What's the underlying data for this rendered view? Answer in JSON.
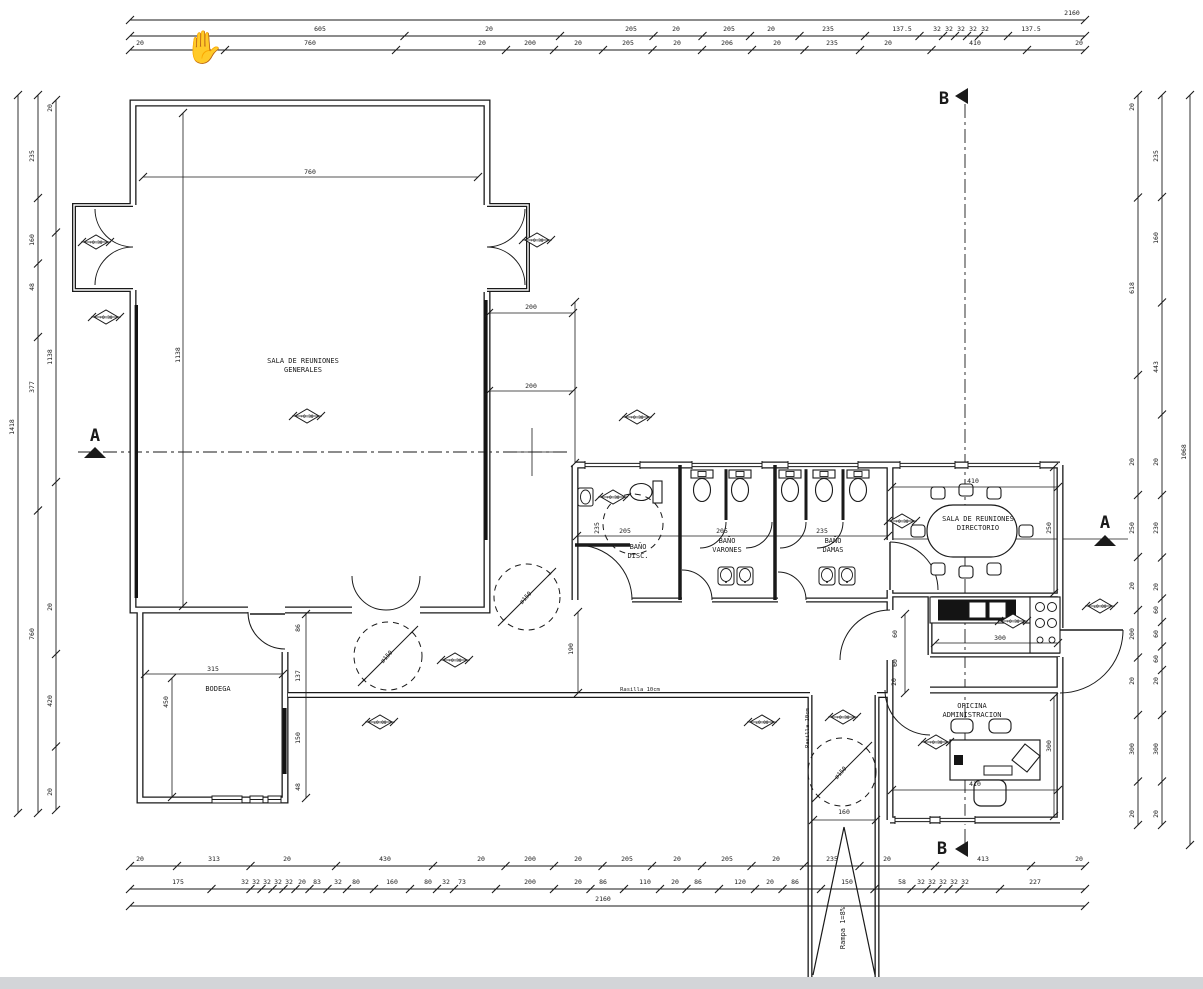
{
  "meta": {
    "background": "#ffffff",
    "line_color": "#1a1a1a",
    "cursor_glyph": "✋",
    "drawing_type": "architectural floor plan"
  },
  "rooms": [
    {
      "x": 303,
      "y": 363,
      "l1": "SALA DE REUNIONES",
      "l2": "GENERALES"
    },
    {
      "x": 218,
      "y": 691,
      "l1": "BODEGA",
      "l2": ""
    },
    {
      "x": 638,
      "y": 549,
      "l1": "BAÑO",
      "l2": "DISC."
    },
    {
      "x": 727,
      "y": 543,
      "l1": "BAÑO",
      "l2": "VARONES"
    },
    {
      "x": 833,
      "y": 543,
      "l1": "BAÑO",
      "l2": "DAMAS"
    },
    {
      "x": 978,
      "y": 521,
      "l1": "SALA DE REUNIONES",
      "l2": "DIRECTORIO"
    },
    {
      "x": 972,
      "y": 708,
      "l1": "OFICINA",
      "l2": "ADMINISTRACION"
    }
  ],
  "annotations": [
    {
      "x": 845,
      "y": 928,
      "t": "Rampa 1=8%",
      "r": -90,
      "s": 7
    },
    {
      "x": 640,
      "y": 691,
      "t": "Rasilla 10cm",
      "r": 0,
      "s": 5.5
    },
    {
      "x": 809,
      "y": 728,
      "t": "Rasilla 10cm",
      "r": -90,
      "s": 5.5
    },
    {
      "x": 527,
      "y": 599,
      "t": "ø150",
      "r": -48,
      "s": 6
    },
    {
      "x": 388,
      "y": 658,
      "t": "ø150",
      "r": -48,
      "s": 6
    },
    {
      "x": 842,
      "y": 774,
      "t": "ø150",
      "r": -48,
      "s": 6
    }
  ],
  "dim_rows": [
    {
      "line": 20,
      "ty": 15,
      "x1": 130,
      "x2": 1085,
      "labels": [
        {
          "x": 1072,
          "t": "2160"
        }
      ]
    },
    {
      "line": 36,
      "ty": 31,
      "x1": 130,
      "x2": 1085,
      "labels": [
        {
          "x": 320,
          "t": "605"
        },
        {
          "x": 489,
          "t": "20"
        },
        {
          "x": 631,
          "t": "205"
        },
        {
          "x": 676,
          "t": "20"
        },
        {
          "x": 729,
          "t": "205"
        },
        {
          "x": 771,
          "t": "20"
        },
        {
          "x": 828,
          "t": "235"
        },
        {
          "x": 902,
          "t": "137.5"
        },
        {
          "x": 937,
          "t": "32"
        },
        {
          "x": 949,
          "t": "32"
        },
        {
          "x": 961,
          "t": "32"
        },
        {
          "x": 973,
          "t": "32"
        },
        {
          "x": 985,
          "t": "32"
        },
        {
          "x": 1031,
          "t": "137.5"
        }
      ]
    },
    {
      "line": 50,
      "ty": 45,
      "x1": 130,
      "x2": 1085,
      "labels": [
        {
          "x": 140,
          "t": "20"
        },
        {
          "x": 310,
          "t": "760"
        },
        {
          "x": 482,
          "t": "20"
        },
        {
          "x": 530,
          "t": "200"
        },
        {
          "x": 578,
          "t": "20"
        },
        {
          "x": 628,
          "t": "205"
        },
        {
          "x": 677,
          "t": "20"
        },
        {
          "x": 727,
          "t": "206"
        },
        {
          "x": 777,
          "t": "20"
        },
        {
          "x": 832,
          "t": "235"
        },
        {
          "x": 888,
          "t": "20"
        },
        {
          "x": 975,
          "t": "410"
        },
        {
          "x": 1079,
          "t": "20"
        }
      ]
    },
    {
      "line": 866,
      "ty": 861,
      "x1": 130,
      "x2": 1085,
      "labels": [
        {
          "x": 140,
          "t": "20"
        },
        {
          "x": 214,
          "t": "313"
        },
        {
          "x": 287,
          "t": "20"
        },
        {
          "x": 385,
          "t": "430"
        },
        {
          "x": 481,
          "t": "20"
        },
        {
          "x": 530,
          "t": "200"
        },
        {
          "x": 578,
          "t": "20"
        },
        {
          "x": 627,
          "t": "205"
        },
        {
          "x": 677,
          "t": "20"
        },
        {
          "x": 727,
          "t": "205"
        },
        {
          "x": 776,
          "t": "20"
        },
        {
          "x": 832,
          "t": "235"
        },
        {
          "x": 887,
          "t": "20"
        },
        {
          "x": 983,
          "t": "413"
        },
        {
          "x": 1079,
          "t": "20"
        }
      ]
    },
    {
      "line": 889,
      "ty": 884,
      "x1": 130,
      "x2": 1085,
      "labels": [
        {
          "x": 178,
          "t": "175"
        },
        {
          "x": 245,
          "t": "32"
        },
        {
          "x": 256,
          "t": "32"
        },
        {
          "x": 267,
          "t": "32"
        },
        {
          "x": 278,
          "t": "32"
        },
        {
          "x": 289,
          "t": "32"
        },
        {
          "x": 302,
          "t": "20"
        },
        {
          "x": 317,
          "t": "83"
        },
        {
          "x": 338,
          "t": "32"
        },
        {
          "x": 356,
          "t": "80"
        },
        {
          "x": 392,
          "t": "160"
        },
        {
          "x": 428,
          "t": "80"
        },
        {
          "x": 446,
          "t": "32"
        },
        {
          "x": 462,
          "t": "73"
        },
        {
          "x": 530,
          "t": "200"
        },
        {
          "x": 578,
          "t": "20"
        },
        {
          "x": 603,
          "t": "86"
        },
        {
          "x": 645,
          "t": "110"
        },
        {
          "x": 675,
          "t": "20"
        },
        {
          "x": 698,
          "t": "86"
        },
        {
          "x": 740,
          "t": "120"
        },
        {
          "x": 770,
          "t": "20"
        },
        {
          "x": 795,
          "t": "86"
        },
        {
          "x": 847,
          "t": "150"
        },
        {
          "x": 902,
          "t": "58"
        },
        {
          "x": 921,
          "t": "32"
        },
        {
          "x": 932,
          "t": "32"
        },
        {
          "x": 943,
          "t": "32"
        },
        {
          "x": 954,
          "t": "32"
        },
        {
          "x": 965,
          "t": "32"
        },
        {
          "x": 1035,
          "t": "227"
        }
      ]
    },
    {
      "line": 906,
      "ty": 901,
      "x1": 130,
      "x2": 1085,
      "labels": [
        {
          "x": 603,
          "t": "2160"
        }
      ]
    }
  ],
  "dim_cols": [
    {
      "x": 18,
      "tx": 14,
      "y1": 95,
      "y2": 813,
      "labels": [
        {
          "y": 427,
          "t": "1418"
        }
      ]
    },
    {
      "x": 38,
      "tx": 34,
      "y1": 95,
      "y2": 813,
      "labels": [
        {
          "y": 156,
          "t": "235"
        },
        {
          "y": 240,
          "t": "160"
        },
        {
          "y": 287,
          "t": "48"
        },
        {
          "y": 387,
          "t": "377"
        },
        {
          "y": 634,
          "t": "760"
        }
      ]
    },
    {
      "x": 56,
      "tx": 52,
      "y1": 100,
      "y2": 810,
      "labels": [
        {
          "y": 108,
          "t": "20"
        },
        {
          "y": 357,
          "t": "1138"
        },
        {
          "y": 607,
          "t": "20"
        },
        {
          "y": 701,
          "t": "420"
        },
        {
          "y": 792,
          "t": "20"
        }
      ]
    },
    {
      "x": 1138,
      "tx": 1134,
      "y1": 95,
      "y2": 825,
      "labels": [
        {
          "y": 107,
          "t": "20"
        },
        {
          "y": 288,
          "t": "618"
        },
        {
          "y": 462,
          "t": "20"
        },
        {
          "y": 528,
          "t": "250"
        },
        {
          "y": 586,
          "t": "20"
        },
        {
          "y": 634,
          "t": "200"
        },
        {
          "y": 681,
          "t": "20"
        },
        {
          "y": 749,
          "t": "300"
        },
        {
          "y": 814,
          "t": "20"
        }
      ]
    },
    {
      "x": 1162,
      "tx": 1158,
      "y1": 95,
      "y2": 825,
      "labels": [
        {
          "y": 156,
          "t": "235"
        },
        {
          "y": 238,
          "t": "160"
        },
        {
          "y": 367,
          "t": "443"
        },
        {
          "y": 462,
          "t": "20"
        },
        {
          "y": 528,
          "t": "230"
        },
        {
          "y": 587,
          "t": "20"
        },
        {
          "y": 610,
          "t": "60"
        },
        {
          "y": 634,
          "t": "60"
        },
        {
          "y": 659,
          "t": "60"
        },
        {
          "y": 681,
          "t": "20"
        },
        {
          "y": 749,
          "t": "300"
        },
        {
          "y": 814,
          "t": "20"
        }
      ]
    },
    {
      "x": 1190,
      "tx": 1186,
      "y1": 95,
      "y2": 845,
      "labels": [
        {
          "y": 452,
          "t": "1068"
        }
      ]
    }
  ],
  "interior_dims": [
    {
      "x": 310,
      "y": 174,
      "t": "760"
    },
    {
      "x": 180,
      "y": 355,
      "t": "1138",
      "r": -90
    },
    {
      "x": 531,
      "y": 309,
      "t": "200"
    },
    {
      "x": 531,
      "y": 388,
      "t": "200"
    },
    {
      "x": 625,
      "y": 533,
      "t": "205"
    },
    {
      "x": 722,
      "y": 533,
      "t": "205"
    },
    {
      "x": 822,
      "y": 533,
      "t": "235"
    },
    {
      "x": 599,
      "y": 528,
      "t": "235",
      "r": -90
    },
    {
      "x": 973,
      "y": 483,
      "t": "410"
    },
    {
      "x": 1051,
      "y": 528,
      "t": "250",
      "r": -90
    },
    {
      "x": 213,
      "y": 671,
      "t": "315"
    },
    {
      "x": 168,
      "y": 702,
      "t": "450",
      "r": -90
    },
    {
      "x": 300,
      "y": 628,
      "t": "86",
      "r": -90
    },
    {
      "x": 300,
      "y": 676,
      "t": "137",
      "r": -90
    },
    {
      "x": 300,
      "y": 738,
      "t": "150",
      "r": -90
    },
    {
      "x": 300,
      "y": 787,
      "t": "48",
      "r": -90
    },
    {
      "x": 573,
      "y": 649,
      "t": "190",
      "r": -90
    },
    {
      "x": 1000,
      "y": 640,
      "t": "300"
    },
    {
      "x": 975,
      "y": 786,
      "t": "410"
    },
    {
      "x": 1051,
      "y": 746,
      "t": "300",
      "r": -90
    },
    {
      "x": 897,
      "y": 634,
      "t": "60",
      "r": -90
    },
    {
      "x": 897,
      "y": 663,
      "t": "60",
      "r": -90
    },
    {
      "x": 896,
      "y": 682,
      "t": "20",
      "r": -90
    },
    {
      "x": 844,
      "y": 814,
      "t": "160"
    }
  ],
  "levels": [
    {
      "x": 96,
      "y": 242,
      "t": "+0.30"
    },
    {
      "x": 106,
      "y": 317,
      "t": "+0.30"
    },
    {
      "x": 307,
      "y": 416,
      "t": "+0.30"
    },
    {
      "x": 537,
      "y": 240,
      "t": "+0.30"
    },
    {
      "x": 637,
      "y": 417,
      "t": "+0.30"
    },
    {
      "x": 613,
      "y": 497,
      "t": "+0.30"
    },
    {
      "x": 902,
      "y": 521,
      "t": "+0.30"
    },
    {
      "x": 1013,
      "y": 621,
      "t": "+0.30"
    },
    {
      "x": 1100,
      "y": 606,
      "t": "±0.00"
    },
    {
      "x": 455,
      "y": 660,
      "t": "+0.30"
    },
    {
      "x": 380,
      "y": 722,
      "t": "±0.00"
    },
    {
      "x": 762,
      "y": 722,
      "t": "±0.00"
    },
    {
      "x": 843,
      "y": 717,
      "t": "+0.30"
    },
    {
      "x": 936,
      "y": 742,
      "t": "+0.30"
    }
  ],
  "sections": [
    {
      "l": "A",
      "x": 95,
      "y": 441,
      "tx": 95,
      "ty": 452,
      "dir": "up"
    },
    {
      "l": "A",
      "x": 1105,
      "y": 528,
      "tx": 1105,
      "ty": 540,
      "dir": "up"
    },
    {
      "l": "B",
      "x": 944,
      "y": 104,
      "tx": 962,
      "ty": 96,
      "dir": "left"
    },
    {
      "l": "B",
      "x": 942,
      "y": 854,
      "tx": 962,
      "ty": 849,
      "dir": "left"
    }
  ]
}
